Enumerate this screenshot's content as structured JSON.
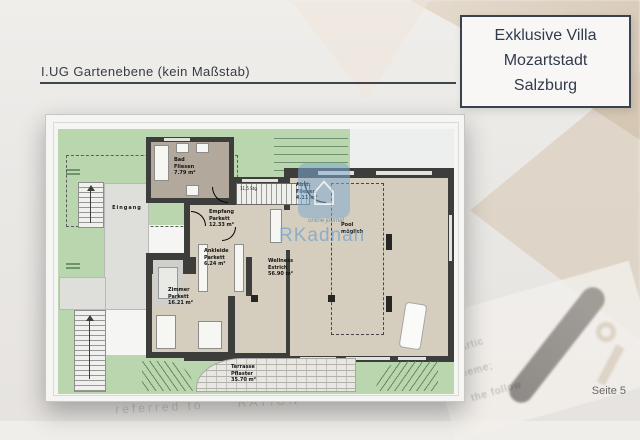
{
  "header": {
    "title": "I.UG Gartenebene (kein Maßstab)"
  },
  "title_box": {
    "lines": [
      "Exklusive Villa",
      "Mozartstadt",
      "Salzburg"
    ]
  },
  "footer": {
    "page_label": "Seite 5"
  },
  "watermark": {
    "icon": "house-icon",
    "subtitle": "online journal",
    "brand": "RKadnan"
  },
  "floorplan": {
    "caption_rooms": {
      "bad": {
        "name": "Bad",
        "material": "Fliesen",
        "area": "7.79 m²"
      },
      "empfang": {
        "name": "Empfang",
        "material": "Parkett",
        "area": "12.33 m²"
      },
      "abstell": {
        "name": "Abst.",
        "material": "Fliesen",
        "area": "4.11 m²"
      },
      "ankleide": {
        "name": "Ankleide",
        "material": "Parkett",
        "area": "6.24 m²"
      },
      "zimmer": {
        "name": "Zimmer",
        "material": "Parkett",
        "area": "16.21 m²"
      },
      "wellness": {
        "name": "Wellness",
        "material": "Estrich",
        "area": "56.90 m²"
      },
      "terrasse": {
        "name": "Terrasse",
        "material": "Pflaster",
        "area": "35.70 m²"
      }
    },
    "annotations": {
      "eingang": "Eingang",
      "pool_line1": "Pool",
      "pool_line2": "möglich",
      "stairs_note": "11,5 Stg"
    }
  },
  "background_fragments": {
    "f1": "Partic",
    "f2": "greeme;",
    "f3": "the follow",
    "f4": "referred to",
    "f5": "RATION",
    "f6": "es from"
  },
  "colors": {
    "accent_border": "#3a4250",
    "garden_green": "#b9d6ae",
    "floor_beige": "#d5cdbe",
    "bath_gray": "#b2a99c",
    "wall_dark": "#3d3d3b",
    "watermark_blue": "#7aa6cb"
  }
}
